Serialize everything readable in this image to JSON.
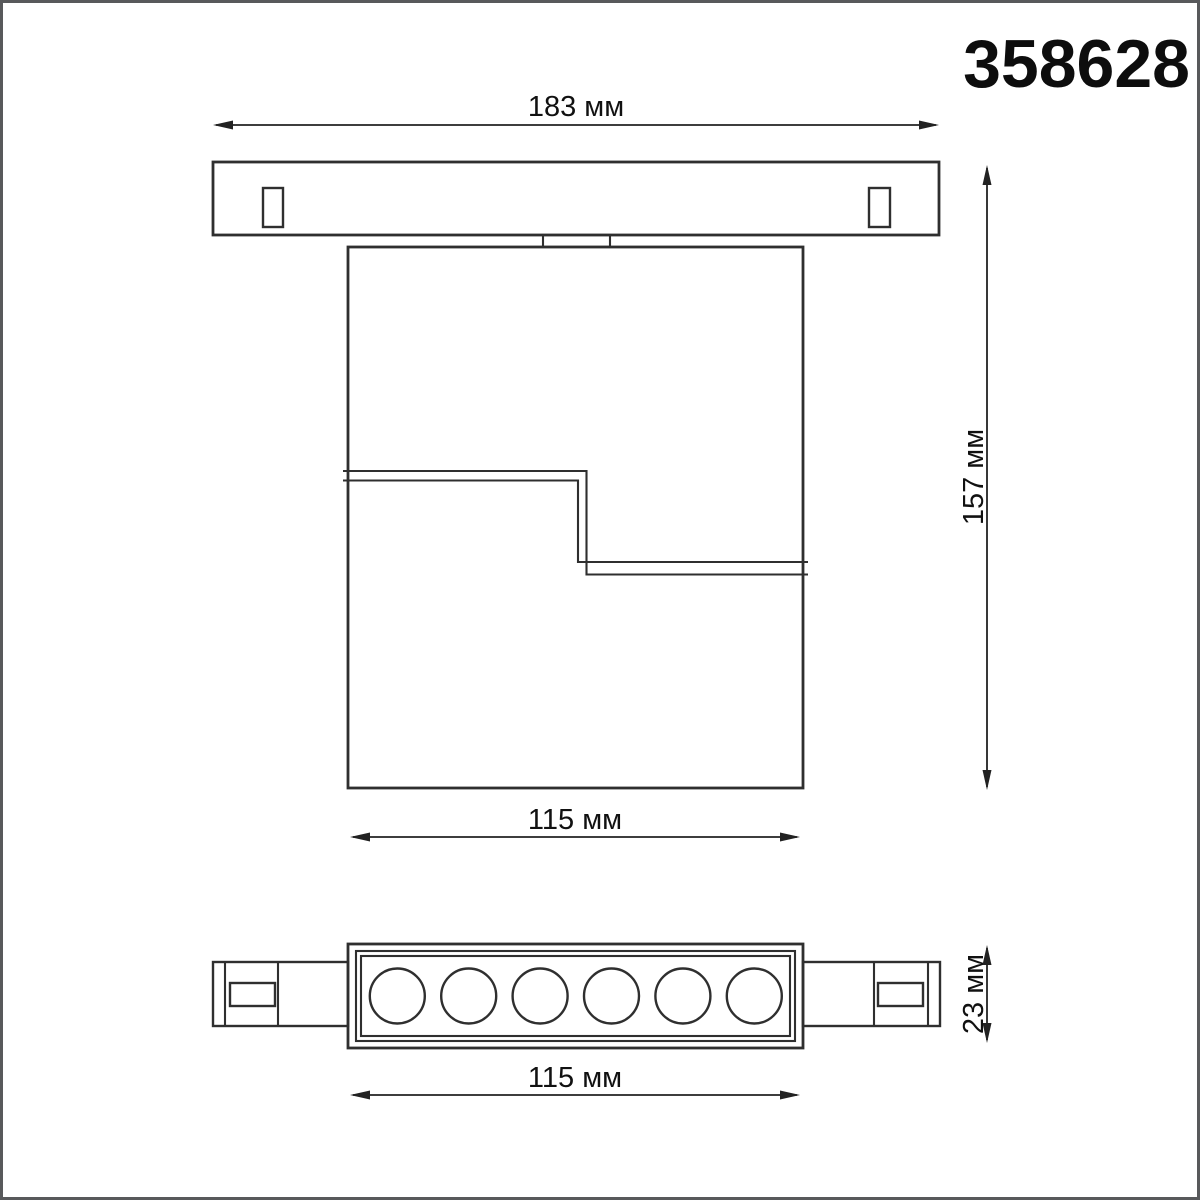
{
  "product": {
    "code": "358628"
  },
  "drawing": {
    "unit": "мм",
    "line_color": "#2f2f2f",
    "text_color": "#111111",
    "frame_color": "#58595b",
    "background": "#ffffff",
    "views": {
      "side_view": {
        "description": "side elevation with mounting track",
        "track_slots": 2
      },
      "bottom_view": {
        "description": "bottom view of linear spot head",
        "led_circles": 6
      }
    },
    "dimensions": {
      "track_width": {
        "label": "183 мм",
        "value": 183
      },
      "fixture_height": {
        "label": "157 мм",
        "value": 157
      },
      "body_width_top": {
        "label": "115 мм",
        "value": 115
      },
      "fixture_depth": {
        "label": "23 мм",
        "value": 23
      },
      "body_width_bottom": {
        "label": "115 мм",
        "value": 115
      }
    }
  }
}
